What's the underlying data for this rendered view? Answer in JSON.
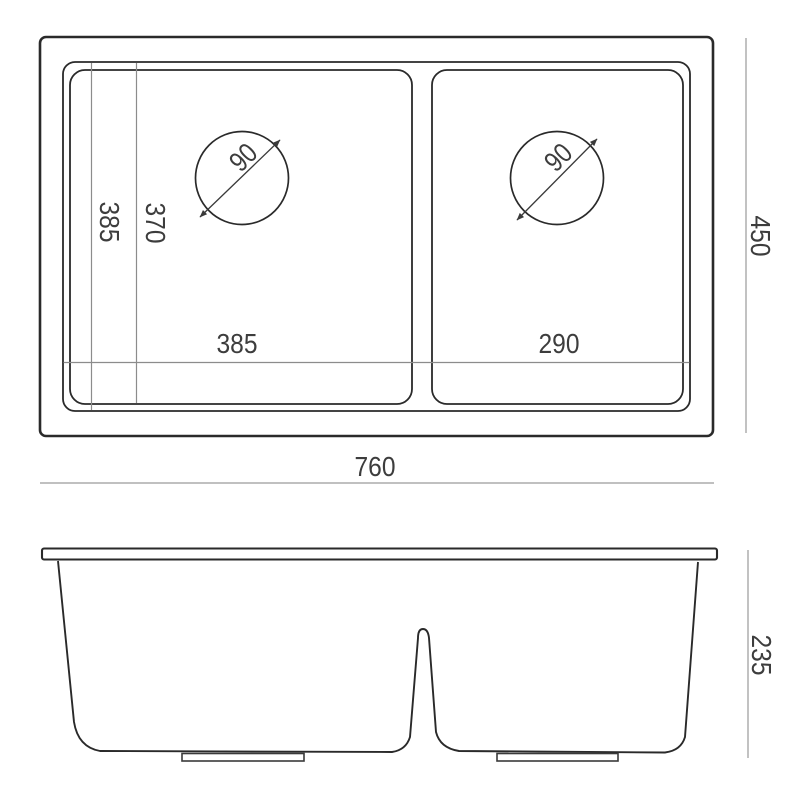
{
  "colors": {
    "background": "#ffffff",
    "main_line": "#2a2a2a",
    "reference_line": "#8c8c8c",
    "dimension_line": "#9a9a9a",
    "dimension_text": "#3d3d3d"
  },
  "top_view": {
    "overall_width": "760",
    "overall_depth": "450",
    "depth_outer": "385",
    "depth_inner": "370",
    "left_bowl": {
      "width": "385",
      "drain_diameter": "90"
    },
    "right_bowl": {
      "width": "290",
      "drain_diameter": "90"
    }
  },
  "front_view": {
    "overall_height": "235"
  }
}
